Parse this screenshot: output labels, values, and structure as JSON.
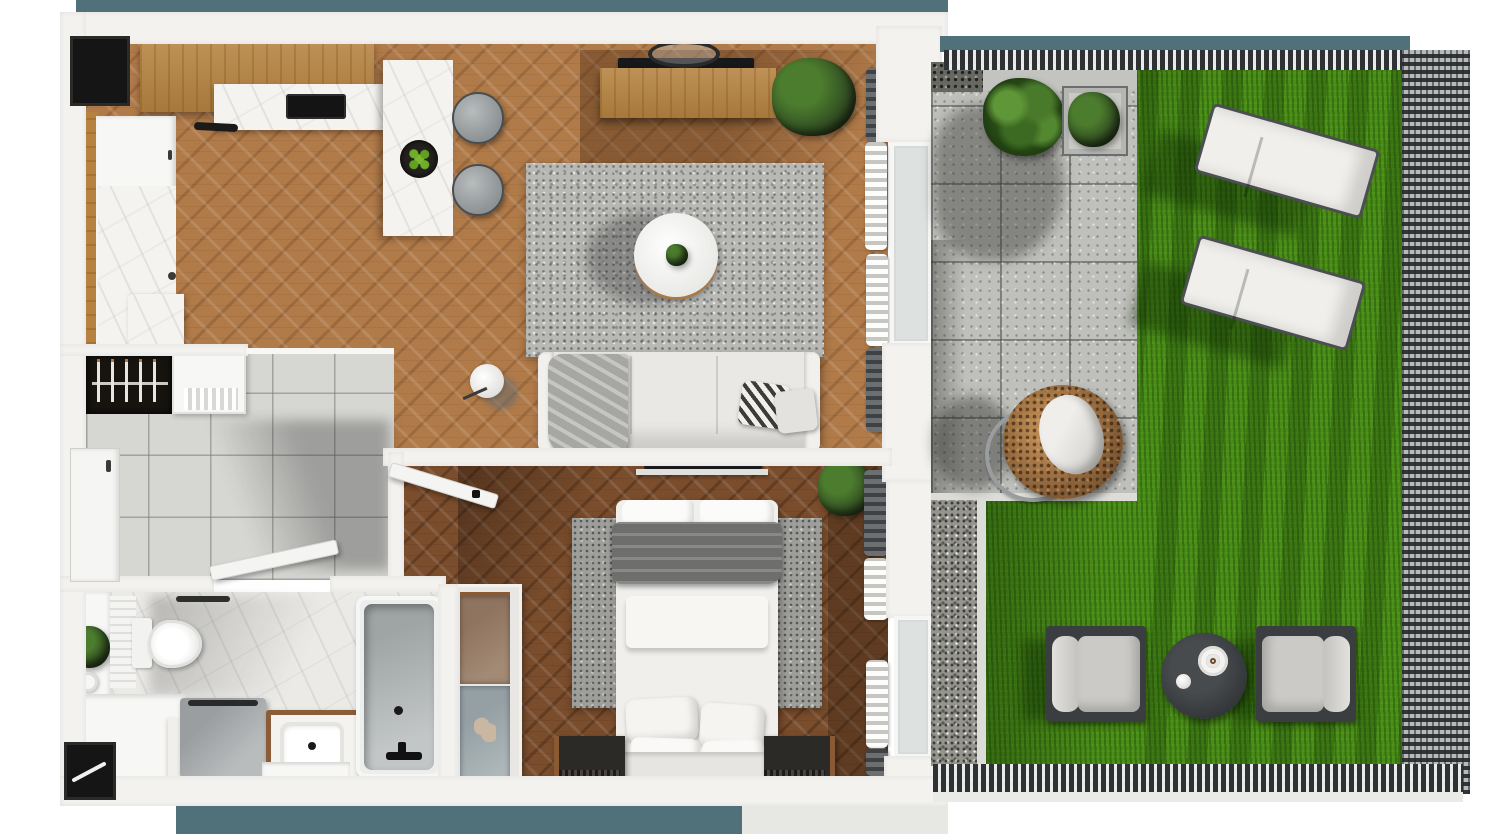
{
  "scene": {
    "type": "3d-floor-plan-render",
    "view": "top-down",
    "width_px": 1500,
    "height_px": 837
  },
  "colors": {
    "teal": "#50707a",
    "wall": "#f3f2ef",
    "white": "#f7f7f5",
    "black": "#151515",
    "woodfloor": "#b07a49",
    "woodfloordark": "#7a4d2c",
    "woodcab": "#b5823f",
    "marble": "#f4f3f0",
    "tile": "#d6d6d3",
    "bathfloor": "#ebeae7",
    "rug": "#b8b8b5",
    "rugdark": "#9e9e9b",
    "sofa": "#e9e8e5",
    "blanket": "#6e6e6d",
    "throwgray": "#a6a6a3",
    "grass": "#4a8c18",
    "paver": "#bfbfbb",
    "gravel": "#95958e",
    "pebble": "#686863",
    "fence": "#2e3234",
    "curb": "#dcdcd8",
    "glass": "#dde2e1",
    "rattan": "#9b6a38",
    "darkwood": "#2c2a27",
    "frame": "#3e4245",
    "plant": "#4c7c2e",
    "plantdark": "#283d1d"
  },
  "apartment": {
    "rooms": [
      {
        "id": "kitchen-living",
        "label": "open kitchen and living room",
        "floor": "herringbone oak"
      },
      {
        "id": "hallway",
        "label": "entry hallway",
        "floor": "gray tile"
      },
      {
        "id": "bathroom",
        "label": "bathroom",
        "floor": "white marble"
      },
      {
        "id": "bedroom",
        "label": "bedroom",
        "floor": "dark herringbone oak"
      }
    ],
    "kitchen_items": [
      "wall-counter",
      "marble-worktop",
      "cooktop",
      "kitchen-island",
      "fruit-bowl",
      "bar-stool",
      "bar-stool",
      "tall-cabinet-column",
      "wood-side-panel"
    ],
    "living_items": [
      "tv",
      "tv-console",
      "ceiling-lamp",
      "potted-plant",
      "area-rug",
      "round-coffee-table",
      "table-plant",
      "floor-lamp",
      "sofa",
      "throw-blanket",
      "striped-pillow",
      "plain-pillow",
      "curtains"
    ],
    "hallway_items": [
      "open-wardrobe",
      "coat-hangers-x5",
      "shoe-cabinet",
      "entrance-door",
      "bathroom-door",
      "bedroom-door"
    ],
    "bathroom_items": [
      "vanity-shelf",
      "plant",
      "toilet",
      "towel-bar",
      "washing-machine",
      "sink-vanity",
      "bathtub",
      "corner-counter"
    ],
    "bedroom_items": [
      "double-bed",
      "pillows-x4",
      "gray-runner-blanket",
      "bedside-bench",
      "bedside-bench",
      "area-rug",
      "wall-tv",
      "wardrobe-glass",
      "potted-plant",
      "curtains"
    ]
  },
  "garden": {
    "zones": [
      {
        "id": "patio",
        "label": "concrete paver patio"
      },
      {
        "id": "lawn",
        "label": "grass lawn"
      },
      {
        "id": "gravel-strip",
        "label": "gravel drainage strip"
      }
    ],
    "items": [
      "fence-top",
      "fence-right",
      "fence-bottom",
      "big-plant",
      "metal-planter",
      "pebble-patch",
      "hanging-egg-chair",
      "sun-lounger",
      "sun-lounger",
      "outdoor-armchair",
      "outdoor-armchair",
      "round-side-table",
      "coffee-cup",
      "decor-ball"
    ]
  }
}
